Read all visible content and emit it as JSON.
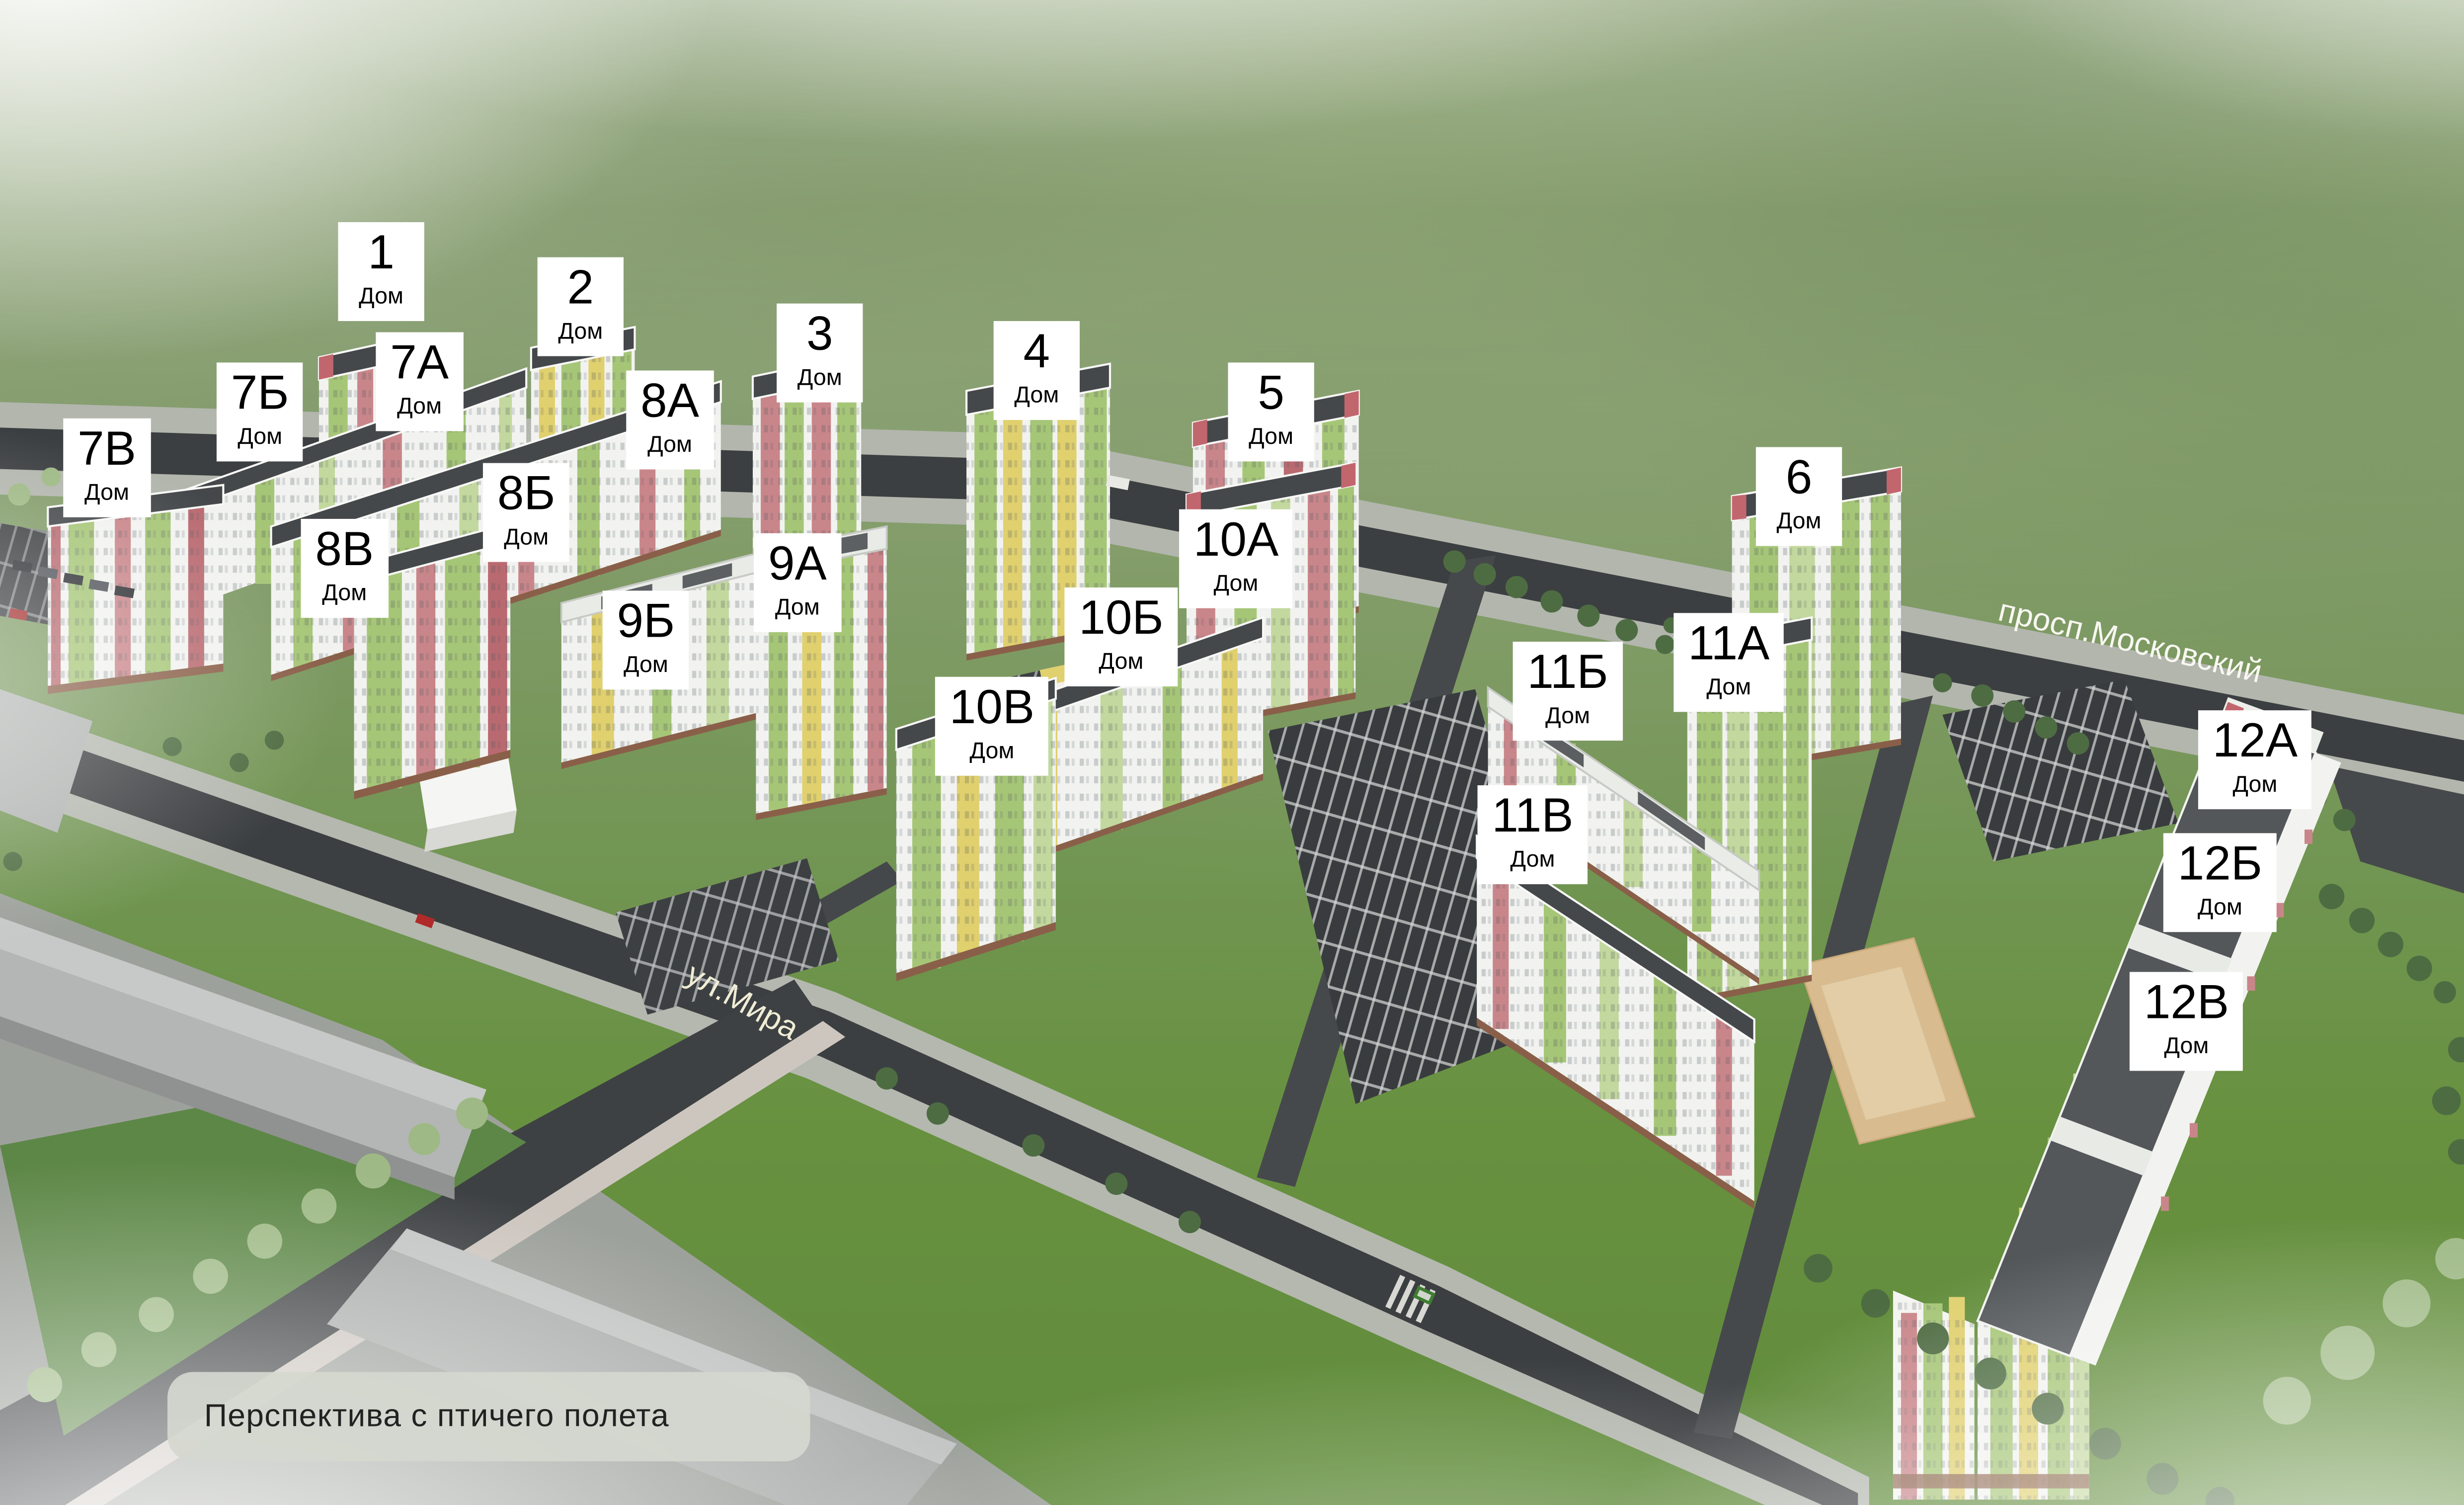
{
  "scene": {
    "type": "residential-complex-masterplan-render",
    "caption": "Перспектива с птичего полета",
    "streets": [
      {
        "id": "prosp-moskovsky",
        "name": "просп.Московский"
      },
      {
        "id": "ul-mira",
        "name": "ул.Мира"
      }
    ],
    "building_labels": [
      {
        "id": "1",
        "number": "1",
        "sub": "Дом"
      },
      {
        "id": "2",
        "number": "2",
        "sub": "Дом"
      },
      {
        "id": "3",
        "number": "3",
        "sub": "Дом"
      },
      {
        "id": "4",
        "number": "4",
        "sub": "Дом"
      },
      {
        "id": "5",
        "number": "5",
        "sub": "Дом"
      },
      {
        "id": "6",
        "number": "6",
        "sub": "Дом"
      },
      {
        "id": "7A",
        "number": "7А",
        "sub": "Дом"
      },
      {
        "id": "7B",
        "number": "7Б",
        "sub": "Дом"
      },
      {
        "id": "7V",
        "number": "7В",
        "sub": "Дом"
      },
      {
        "id": "8A",
        "number": "8А",
        "sub": "Дом"
      },
      {
        "id": "8B",
        "number": "8Б",
        "sub": "Дом"
      },
      {
        "id": "8V",
        "number": "8В",
        "sub": "Дом"
      },
      {
        "id": "9A",
        "number": "9А",
        "sub": "Дом"
      },
      {
        "id": "9B",
        "number": "9Б",
        "sub": "Дом"
      },
      {
        "id": "10A",
        "number": "10А",
        "sub": "Дом"
      },
      {
        "id": "10B",
        "number": "10Б",
        "sub": "Дом"
      },
      {
        "id": "10V",
        "number": "10В",
        "sub": "Дом"
      },
      {
        "id": "11A",
        "number": "11А",
        "sub": "Дом"
      },
      {
        "id": "11B",
        "number": "11Б",
        "sub": "Дом"
      },
      {
        "id": "11V",
        "number": "11В",
        "sub": "Дом"
      },
      {
        "id": "12A",
        "number": "12А",
        "sub": "Дом"
      },
      {
        "id": "12B",
        "number": "12Б",
        "sub": "Дом"
      },
      {
        "id": "12V",
        "number": "12В",
        "sub": "Дом"
      }
    ],
    "colors": {
      "facade_white": "#f2f3f0",
      "panel_green": "#a6c677",
      "panel_light_green": "#c3d89e",
      "panel_yellow": "#e0d06e",
      "panel_red": "#c9868a",
      "roof_dark": "#45484a",
      "asphalt": "#3c3f41",
      "label_bg": "#ffffff",
      "label_text": "#000000",
      "lawn_green": "#67913f"
    }
  }
}
